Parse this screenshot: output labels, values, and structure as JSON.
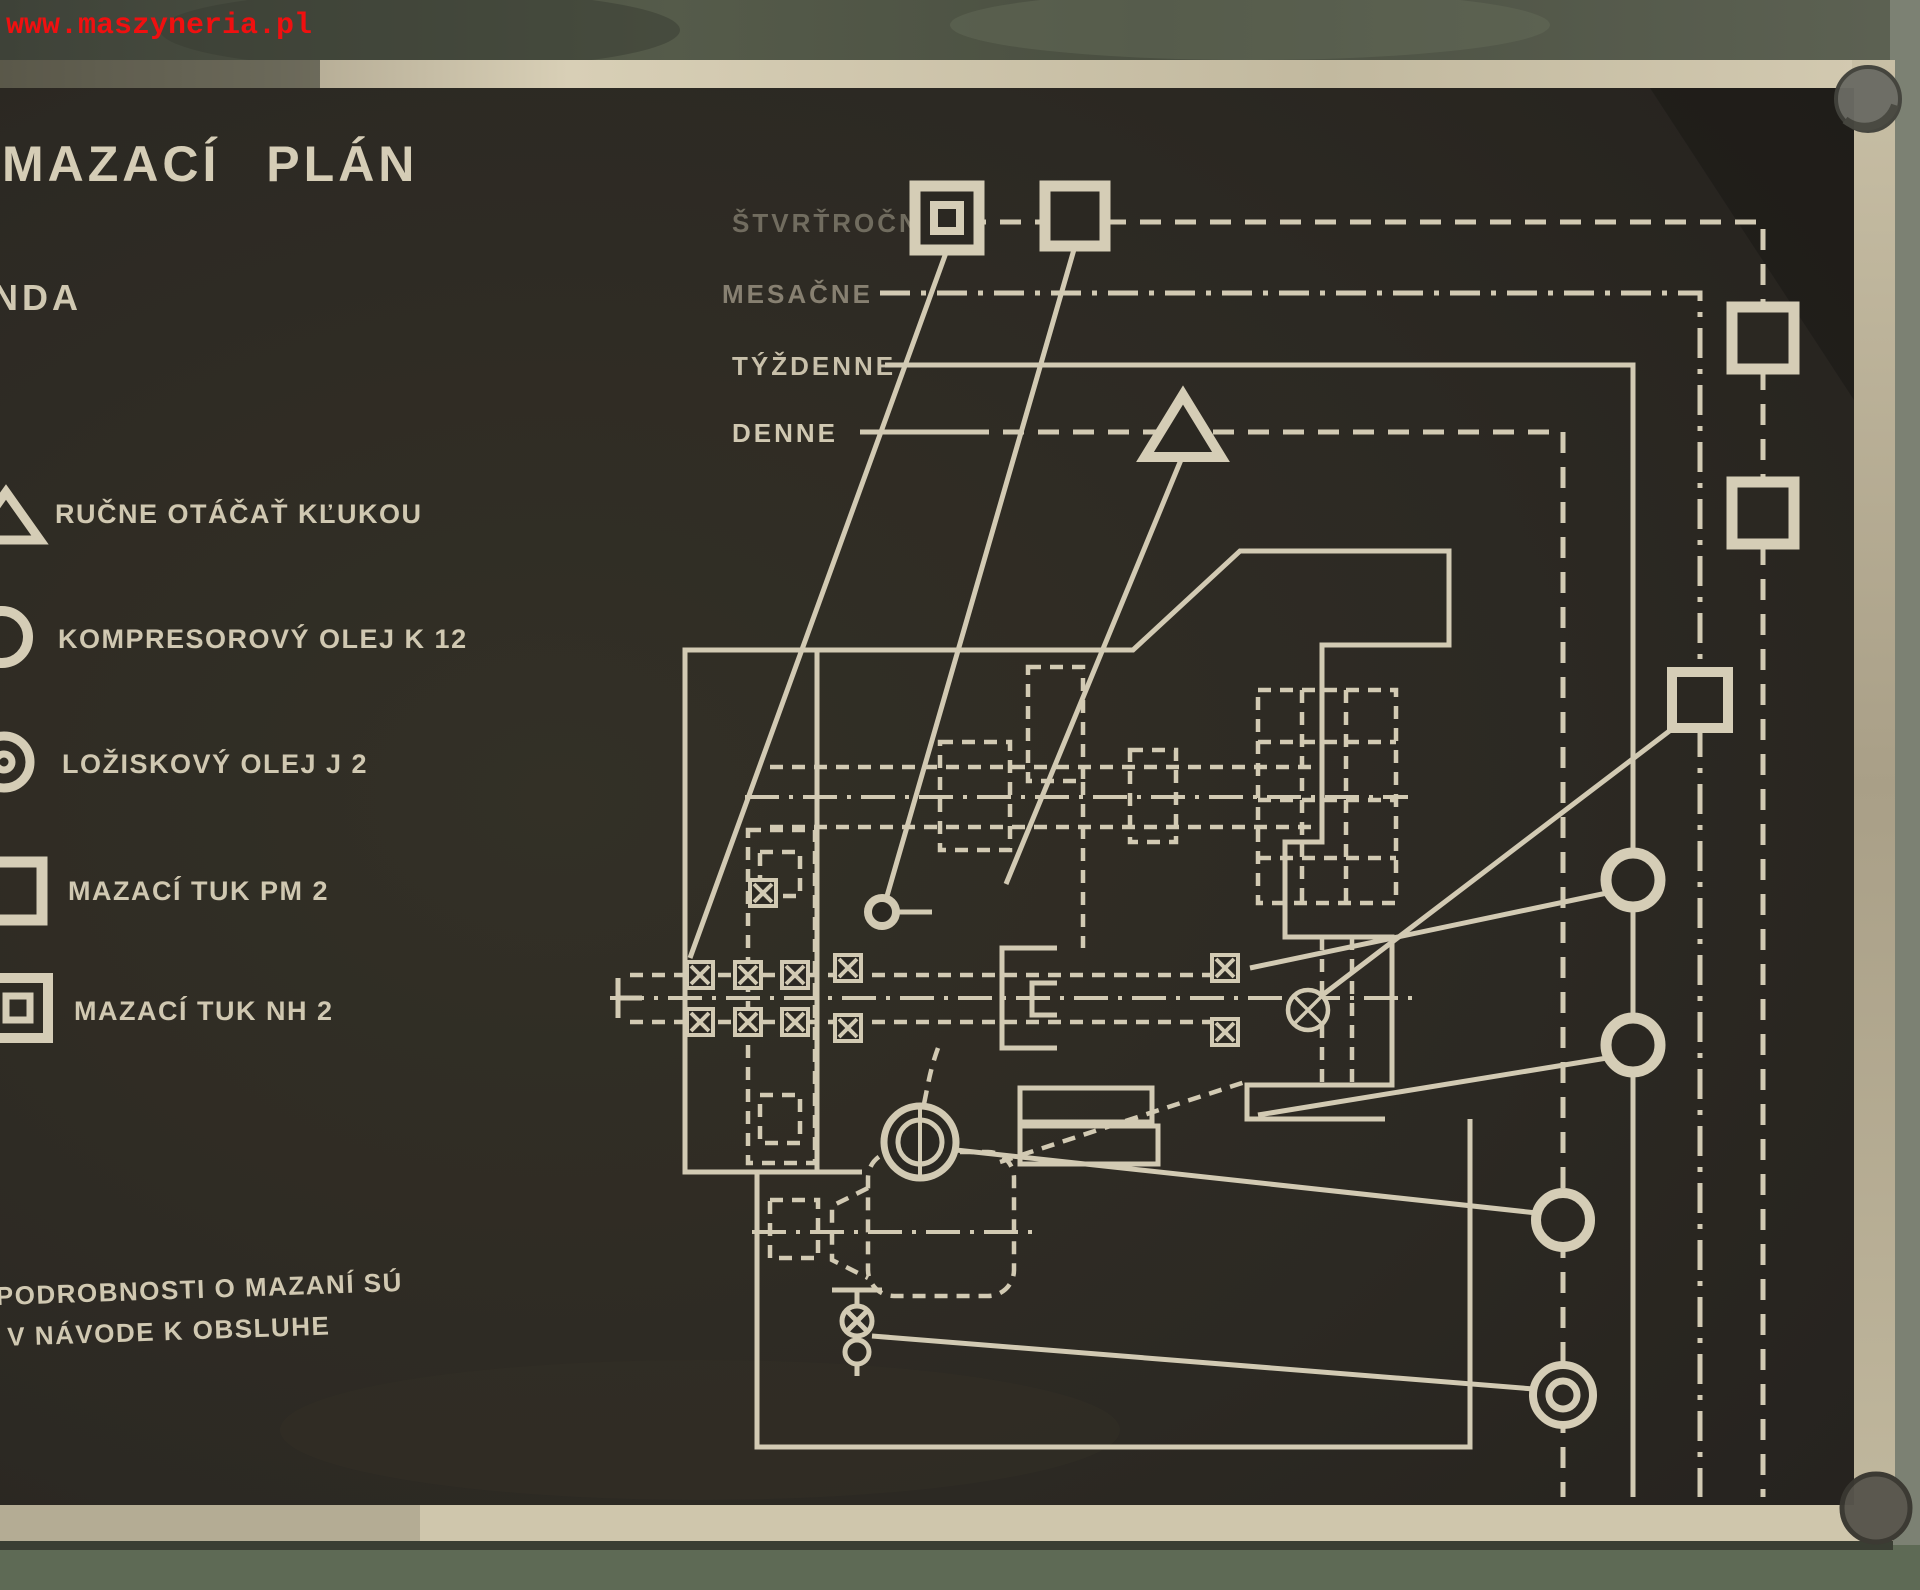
{
  "watermark": {
    "text": "www.maszyneria.pl",
    "color": "#f01010"
  },
  "plate": {
    "title": "MAZACÍ PLÁN",
    "background": "#2e2b25",
    "ink": "#e3dac2",
    "frame_color": "#cdc4aa"
  },
  "legend": {
    "heading": "NDA",
    "items": [
      {
        "symbol": "triangle-icon",
        "label": "RUČNE OTÁČAŤ KĽUKOU"
      },
      {
        "symbol": "circle-icon",
        "label": "KOMPRESOROVÝ OLEJ K 12"
      },
      {
        "symbol": "circle-dot-icon",
        "label": "LOŽISKOVÝ OLEJ J 2"
      },
      {
        "symbol": "square-icon",
        "label": "MAZACÍ TUK PM 2"
      },
      {
        "symbol": "square-dot-icon",
        "label": "MAZACÍ TUK NH 2"
      }
    ]
  },
  "schedule": {
    "rows": [
      {
        "label": "ŠTVRŤROČNE",
        "line_style": "dashed"
      },
      {
        "label": "MESAČNE",
        "line_style": "dash-dot"
      },
      {
        "label": "TÝŽDENNE",
        "line_style": "solid"
      },
      {
        "label": "DENNE",
        "line_style": "solid-then-dashed"
      }
    ]
  },
  "footnote": {
    "line1": "PODROBNOSTI O MAZANÍ SÚ",
    "line2": "V NÁVODE K OBSLUHE"
  },
  "environment": {
    "machine_body_color": "#59604f"
  }
}
